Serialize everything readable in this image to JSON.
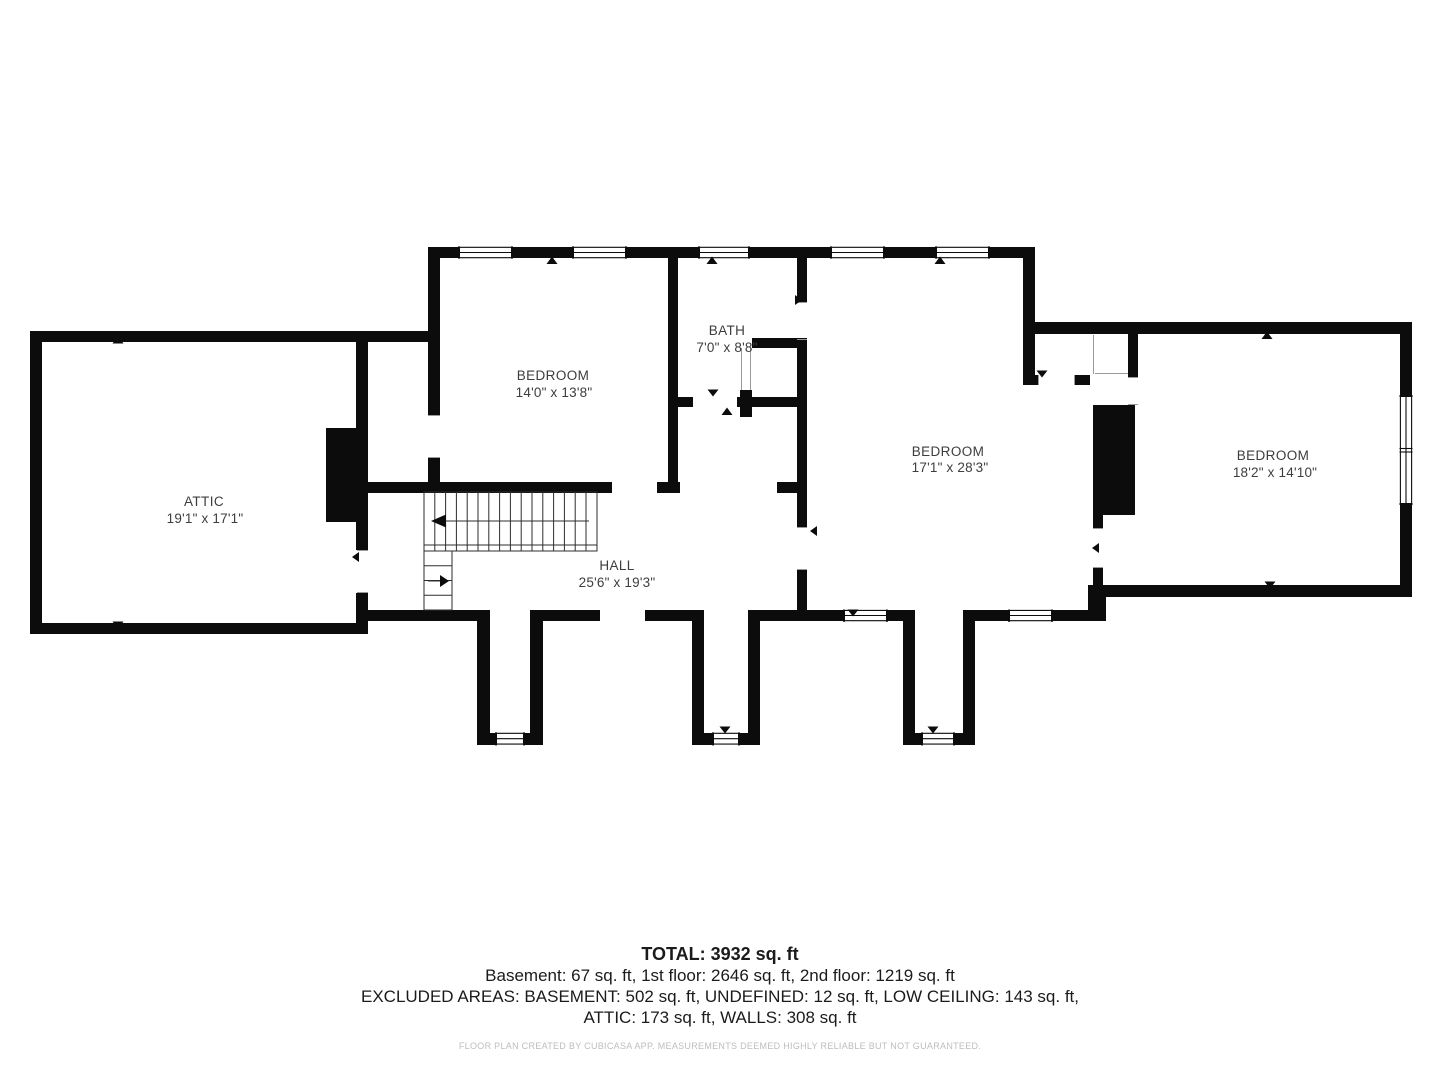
{
  "rooms": [
    {
      "name": "ATTIC",
      "dims": "19'1\" x 17'1\""
    },
    {
      "name": "BEDROOM",
      "dims": "14'0\" x 13'8\""
    },
    {
      "name": "BATH",
      "dims": "7'0\" x 8'8\""
    },
    {
      "name": "BEDROOM",
      "dims": "17'1\" x 28'3\""
    },
    {
      "name": "BEDROOM",
      "dims": "18'2\" x 14'10\""
    },
    {
      "name": "HALL",
      "dims": "25'6\" x 19'3\""
    }
  ],
  "summary": {
    "total": "TOTAL: 3932 sq. ft",
    "floors": "Basement: 67 sq. ft, 1st floor: 2646 sq. ft, 2nd floor: 1219 sq. ft",
    "excluded_line1": "EXCLUDED AREAS: BASEMENT: 502 sq. ft, UNDEFINED: 12 sq. ft, LOW CEILING: 143 sq. ft,",
    "excluded_line2": "ATTIC: 173 sq. ft, WALLS: 308 sq. ft",
    "disclaimer": "FLOOR PLAN CREATED BY CUBICASA APP. MEASUREMENTS DEEMED HIGHLY RELIABLE BUT NOT GUARANTEED."
  },
  "colors": {
    "wall": "#0c0c0c",
    "label": "#3d3d3d",
    "disclaimer": "#bdbdbd"
  }
}
